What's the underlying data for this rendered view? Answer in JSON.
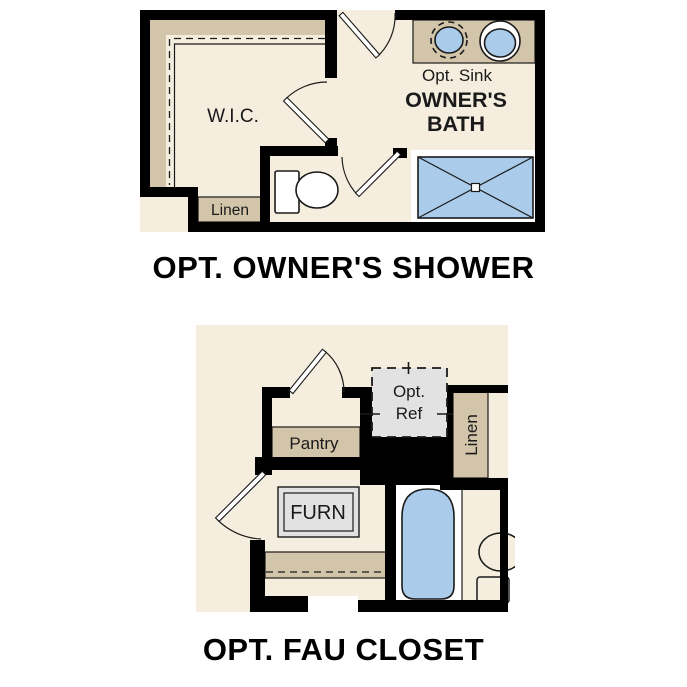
{
  "page": {
    "background": "#ffffff"
  },
  "colors": {
    "wall": "#000000",
    "floor": "#f5eede",
    "shelf": "#d2c5a9",
    "fixture_blue": "#aacbea",
    "equipment_gray": "#e2e2e2",
    "outline": "#1a1a1a",
    "surround": "#ffffff"
  },
  "plan_shower": {
    "caption": "OPT. OWNER'S SHOWER",
    "labels": {
      "wic": "W.I.C.",
      "linen": "Linen",
      "opt_sink": "Opt. Sink",
      "bath_line1": "OWNER'S",
      "bath_line2": "BATH"
    }
  },
  "plan_fau": {
    "caption": "OPT. FAU CLOSET",
    "labels": {
      "pantry": "Pantry",
      "ref_line1": "Opt.",
      "ref_line2": "Ref",
      "linen": "Linen",
      "furn": "FURN"
    }
  }
}
